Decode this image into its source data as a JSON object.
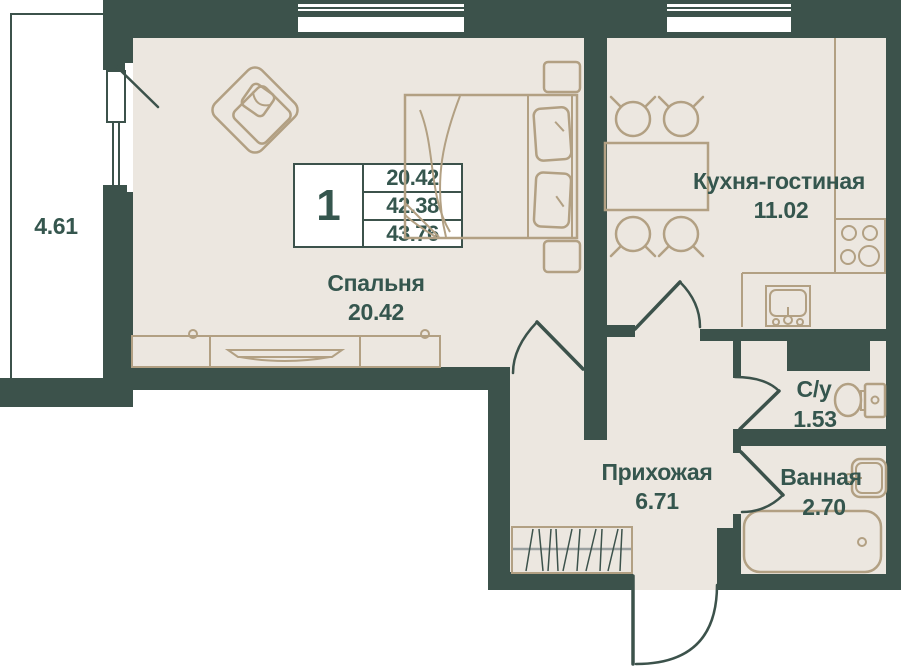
{
  "colors": {
    "wall": "#3c524b",
    "floor": "#ece7e0",
    "furniture": "#b2a083",
    "text": "#35564e",
    "white": "#ffffff",
    "gray": "#9aa0a0"
  },
  "legend": {
    "rooms_count": "1",
    "living_area": "20.42",
    "apartment_area": "42.38",
    "total_area": "43.76"
  },
  "rooms": {
    "bedroom": {
      "name": "Спальня",
      "area": "20.42"
    },
    "kitchen": {
      "name": "Кухня-гостиная",
      "area": "11.02"
    },
    "hallway": {
      "name": "Прихожая",
      "area": "6.71"
    },
    "wc": {
      "name": "С/у",
      "area": "1.53"
    },
    "bathroom": {
      "name": "Ванная",
      "area": "2.70"
    },
    "balcony": {
      "area": "4.61"
    }
  }
}
